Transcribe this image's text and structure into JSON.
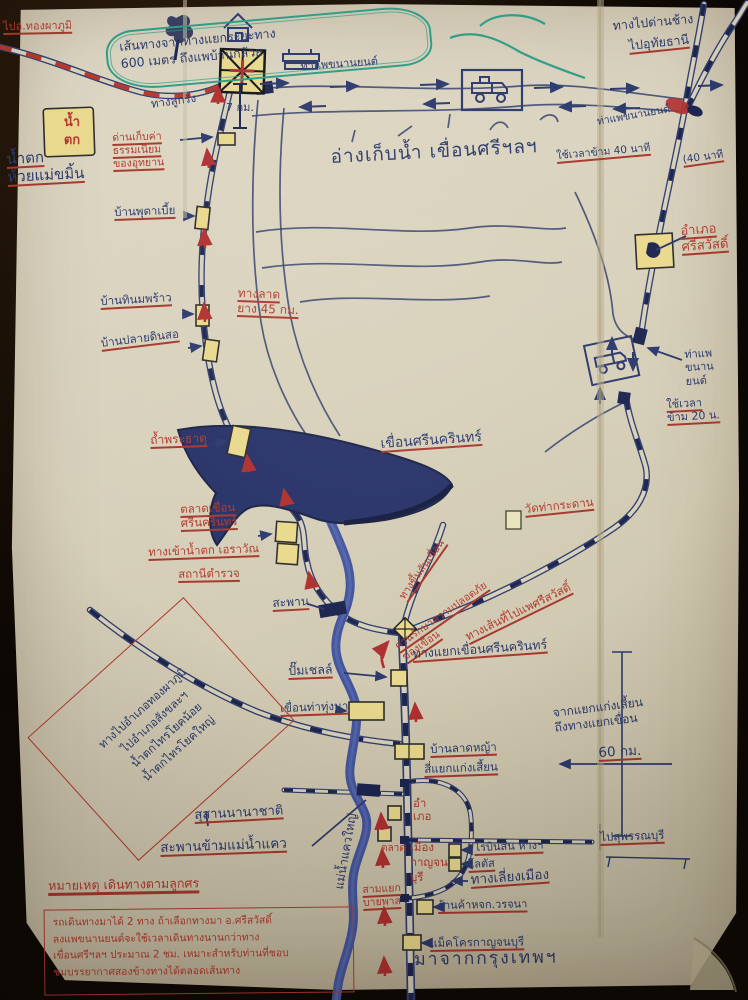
{
  "photo": {
    "type": "hand-drawn tourist route map to Srinagarind Dam, Kanchanaburi",
    "colors": {
      "background": "#0b0703",
      "paper": "#d8d1bc",
      "blue_ink": "#2c3a6d",
      "red_ink": "#b23a2e",
      "green_ink": "#2f9c86",
      "yellow_sign": "#e9d98e",
      "navy": "#1d2650",
      "river_blue": "#44569e"
    }
  },
  "top": {
    "corner_destination": "ไปอ.ทองผาภูมิ",
    "route_note": "เส้นทางจากทางแยกระยะทาง\n600 เมตร ถึงแพบ้านกล้วย",
    "ferry_pier": "ท่าแพขนานยนต์",
    "gravel_road": "ทางลูกรัง",
    "distance_7km": "7 กม.",
    "to_danchang": "ทางไปด่านช้าง",
    "to_uthai": "ไปอุทัยธานี"
  },
  "west_route": {
    "fee_checkpoint": "ด่านเก็บค่า\nธรรมเนียม\nของอุทยาน",
    "waterfall_sign": "น้ำ\nตก",
    "waterfall_name": "น้ำตก\nห้วยแม่ขมิ้น",
    "village_1": "บ้านพุตาเบี้ย",
    "village_2": "บ้านทินมพร้าว",
    "village_3": "บ้านปลายดินสอ",
    "paved_road_45km": "ทางลาด\nยาง 45 กม.",
    "cave": "ถ้ำพระธาตุ"
  },
  "reservoir": {
    "title": "อ่างเก็บน้ำ เขื่อนศรีฯลฯ",
    "dam_name": "เขื่อนศรีนครินทร์",
    "market": "ตลาดเขื่อน\nศรีนครินทร์",
    "erawan_entrance": "ทางเข้าน้ำตก เอราวัณ",
    "police_station": "สถานีตำรวจ",
    "bridge": "สะพาน",
    "dam_crest_road": "ทางขึ้นสันเขื่อน",
    "dam_security_checkpoint": "ด่านรักษาความปลอดภัย\nของเขื่อน",
    "wat_thakradan": "วัดท่ากระดาน",
    "sisawat_route": "ทางเส้นที่ไปแพศรีสวัสดิ์"
  },
  "east_route": {
    "ferry_time_40": "ใช้เวลาข้าม 40 นาที",
    "ferry_time_40b": "(40 นาที",
    "ferry_pier_upper": "ท่าแพขนานยนต์",
    "sisawat_district": "อำเภอ\nศรีสวัสดิ์",
    "ferry_pier_lower": "ท่าแพ\nขนาน\nยนต์",
    "ferry_time_20": "ใช้เวลา\nข้าม 20 น."
  },
  "highway": {
    "dam_junction": "ทางแยกเขื่อนศรีนครินทร์",
    "shell_station": "ปั๊มเชลล์",
    "thathungna_dam": "เขื่อนท่าทุ่งนา",
    "ban_latya": "บ้านลาดหญ้า",
    "kaengsian_intersection": "สี่แยกแก่งเสี้ยน",
    "distance_note": "จากแยกแก่งเสี้ยน\nถึงทางแยกเขื่อน",
    "distance_60km": "60 กม.",
    "west_sign": "ทางไปอำเภอทองผาภูมิ\nไปอำเภอสังขละฯ\nน้ำตกไทรโยคน้อย\nน้ำตกไทรโยคใหญ่"
  },
  "city": {
    "cemetery": "สุสานนานาชาติ",
    "kwai_bridge": "สะพานข้ามแม่น้ำแคว",
    "river_name": "แม่น้ำแควใหญ่",
    "market": "ตลาด",
    "district_office": "อำ\nเภอ",
    "mueang_kanchanaburi": "เมือง\nกาญจน\nบุรี",
    "bypass_junction": "สามแยก\nบายพาส",
    "to_suphanburi": "ไปสุพรรณบุรี",
    "robinson": "โรบินสัน ห้างฯ",
    "lotus": "โลตัส",
    "bypass_road": "ทางเลี่ยงเมือง",
    "worajana_shop": "ร้านค้าหจก.วรจนา",
    "makro": "แม็คโครกาญจนบุรี",
    "from_bangkok": "มาจากกรุงเทพฯ"
  },
  "notes": {
    "title": "หมายเหตุ เดินทางตามลูกศร",
    "body": "รถเดินทางมาได้ 2 ทาง ถ้าเลือกทางมา อ.ศรีสวัสดิ์\nลงแพขนานยนต์จะใช้เวลาเดินทางนานกว่าทาง\nเขื่อนศรีฯลฯ ประมาณ 2 ชม. เหมาะสำหรับท่านที่ชอบ\nชมบรรยากาศสองข้างทางได้ตลอดเส้นทาง"
  },
  "icons": {
    "car_ferry": "pickup-truck-in-box",
    "ferry_raft": "hatched-raft-square",
    "barge": "stacked-bars",
    "house": "hut",
    "tree": "tree-scribble"
  }
}
